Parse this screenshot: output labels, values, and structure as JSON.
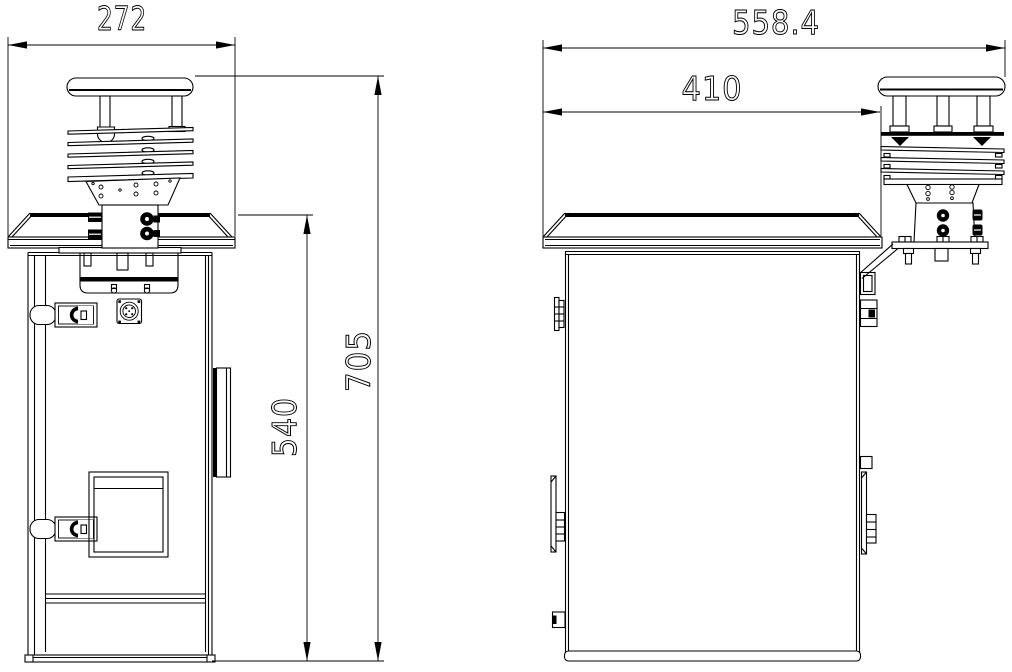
{
  "drawing": {
    "background_color": "#ffffff",
    "line_color": "#000000",
    "views": {
      "front": {
        "dims": {
          "overall_width": "272",
          "body_height": "540",
          "overall_height": "705"
        }
      },
      "side": {
        "dims": {
          "overall_depth": "558.4",
          "roof_depth": "410"
        }
      }
    }
  }
}
